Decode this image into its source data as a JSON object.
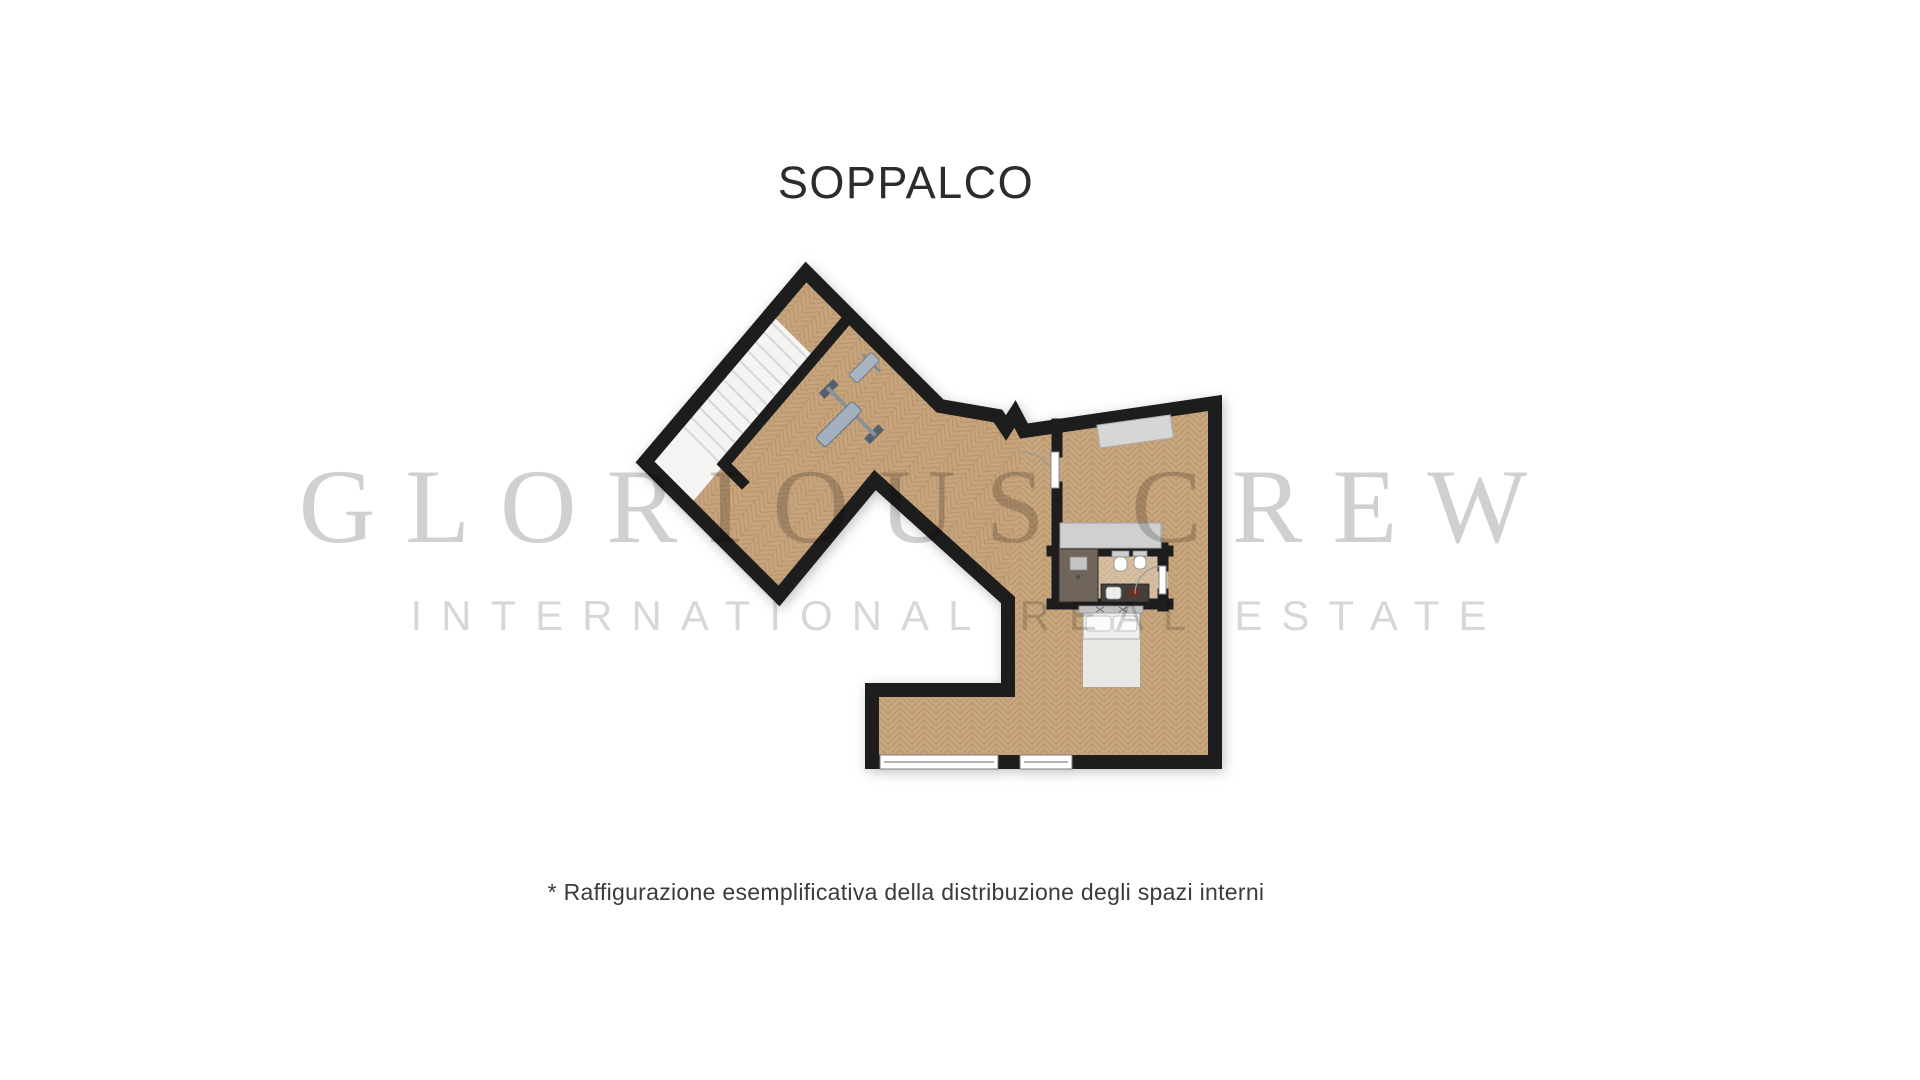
{
  "title": {
    "text": "SOPPALCO"
  },
  "watermark": {
    "line1": "GLORIOUS CREW",
    "line2": "INTERNATIONAL REAL ESTATE"
  },
  "footnote": {
    "text": "* Raffigurazione esemplificativa della distribuzione degli spazi interni"
  },
  "floorplan": {
    "name": "mezzanine-floor-plan",
    "colors": {
      "wall": "#1d1d1d",
      "wood": "#c9a77e",
      "wood_grain": "#b3906a",
      "stairs": "#f4f4f3",
      "stair_tread": "#d7d7d7",
      "shower": "#70655a",
      "closet_counter": "#d0d0d0",
      "wardrobe": "#d6d6d6",
      "bed": "#efefed",
      "sink_counter": "#453f39",
      "window": "#ffffff"
    },
    "elements": [
      "staircase",
      "gym-bench",
      "wardrobe",
      "closet-counter",
      "shower",
      "toilet",
      "bidet",
      "sink-counter",
      "double-bed",
      "room-door",
      "bathroom-door",
      "window-left",
      "window-right"
    ]
  }
}
